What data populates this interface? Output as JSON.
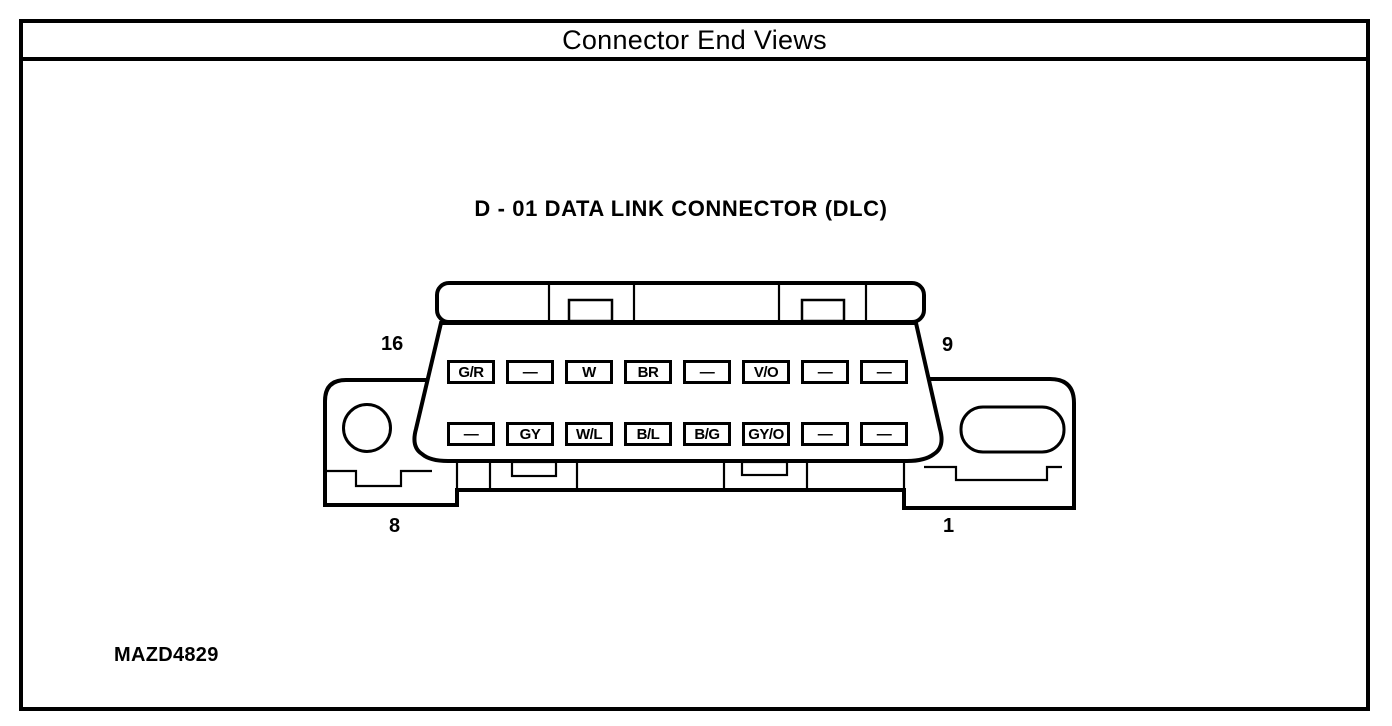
{
  "title": "Connector End Views",
  "diagram": {
    "connector_title": "D - 01 DATA LINK CONNECTOR (DLC)",
    "corner_labels": {
      "top_left": "16",
      "top_right": "9",
      "bottom_left": "8",
      "bottom_right": "1"
    },
    "pin_rows": {
      "top": [
        "G/R",
        "—",
        "W",
        "BR",
        "—",
        "V/O",
        "—",
        "—"
      ],
      "bottom": [
        "—",
        "GY",
        "W/L",
        "B/L",
        "B/G",
        "GY/O",
        "—",
        "—"
      ]
    },
    "figure_id": "MAZD4829"
  },
  "colors": {
    "ink": "#000000",
    "paper": "#ffffff"
  }
}
